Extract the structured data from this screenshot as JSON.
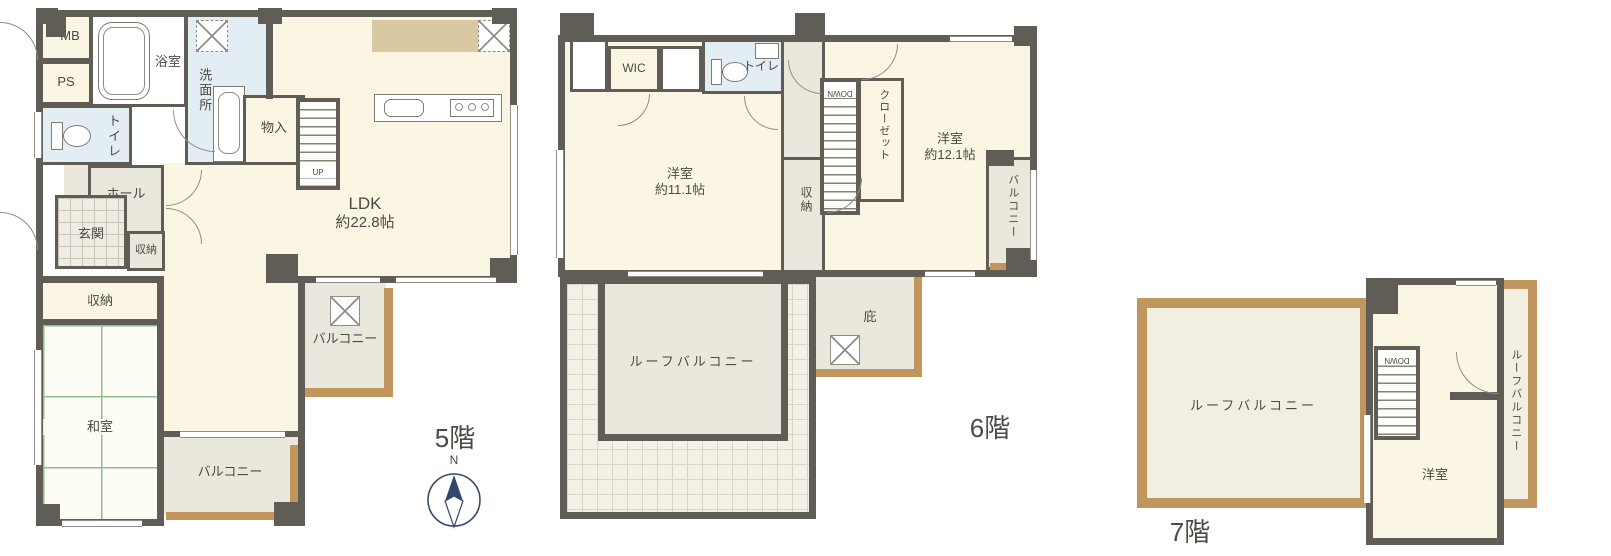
{
  "colors": {
    "wall": "#5f5d55",
    "cream": "#faf6e3",
    "water_blue": "#e2eef3",
    "greige": "#eae7dd",
    "balcony_tan": "#c0965c",
    "tatami_green": "#8fbf8f",
    "compass_navy": "#32486b"
  },
  "compass": {
    "north": "N"
  },
  "floor5": {
    "floor_label": "5階",
    "rooms": {
      "mb": "MB",
      "ps": "PS",
      "bath": "浴室",
      "washroom": "洗面所",
      "toilet": "トイレ",
      "monoire": "物入",
      "ldk_name": "LDK",
      "ldk_size": "約22.8帖",
      "hall": "ホール",
      "genkan": "玄関",
      "storage_small": "収納",
      "storage_band": "収納",
      "washitsu": "和室",
      "balcony_bottom": "バルコニー",
      "balcony_right": "バルコニー",
      "stairs": "UP"
    }
  },
  "floor6": {
    "floor_label": "6階",
    "rooms": {
      "wic": "WIC",
      "toilet": "トイレ",
      "bed1_name": "洋室",
      "bed1_size": "約11.1帖",
      "storage": "収納",
      "closet": "クローゼット",
      "bed2_name": "洋室",
      "bed2_size": "約12.1帖",
      "balcony": "バルコニー",
      "roof_balcony": "ルーフバルコニー",
      "hisashi": "庇",
      "stairs": "DOWN"
    }
  },
  "floor7": {
    "floor_label": "7階",
    "rooms": {
      "roof_balcony_main": "ルーフバルコニー",
      "bedroom": "洋室",
      "roof_balcony_side": "ルーフバルコニー",
      "stairs": "DOWN"
    }
  }
}
